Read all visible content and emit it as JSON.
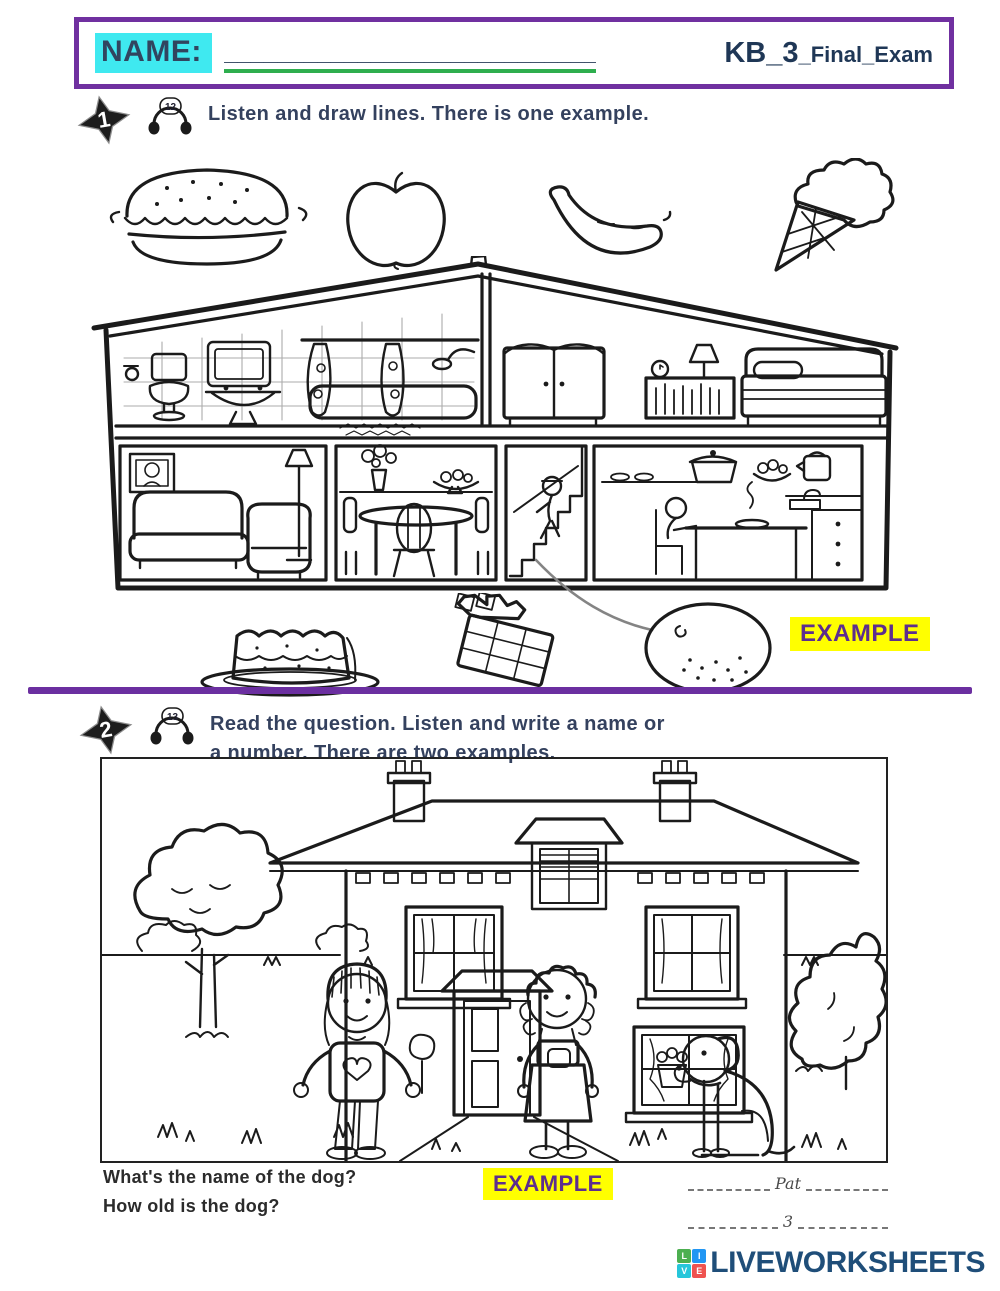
{
  "header": {
    "name_label": "NAME:",
    "name_blank": "__________________________________",
    "title_main": "KB_3",
    "title_sub": "_Final_Exam"
  },
  "section1": {
    "number": "1",
    "track": "12",
    "instruction": "Listen and draw lines. There is one example.",
    "example_label": "EXAMPLE",
    "food_items_top": [
      "hamburger",
      "apple",
      "banana",
      "ice-cream"
    ],
    "food_items_bottom": [
      "cake",
      "chocolate-bar",
      "orange"
    ],
    "house_rooms": [
      "bathroom",
      "bedroom",
      "living-room",
      "dining-room",
      "stairs",
      "kitchen"
    ]
  },
  "section2": {
    "number": "2",
    "track": "13",
    "instruction_line1": "Read the question. Listen and write a name or",
    "instruction_line2": "a number. There are two examples.",
    "example_label": "EXAMPLE",
    "questions": [
      "What's the name of the dog?",
      "How old is the dog?"
    ],
    "answers": [
      "Pat",
      "3"
    ],
    "scene_items": [
      "house",
      "tree",
      "bush",
      "girl-heart-sweater",
      "girl-pinafore",
      "dog"
    ]
  },
  "footer": {
    "brand": "LIVEWORKSHEETS",
    "logo_letters": [
      "L",
      "I",
      "V",
      "E"
    ],
    "logo_colors": [
      "#4CAF50",
      "#2196F3",
      "#26C6DA",
      "#EF5350"
    ]
  },
  "colors": {
    "border_purple": "#7030A0",
    "highlight_cyan": "#3FE9F0",
    "navy_text": "#31455F",
    "underline_green": "#2EAE4E",
    "example_yellow": "#FFFF00",
    "example_purple": "#5D2E8E",
    "divider_purple": "#6B2FA0",
    "footer_blue": "#1F4E79"
  }
}
